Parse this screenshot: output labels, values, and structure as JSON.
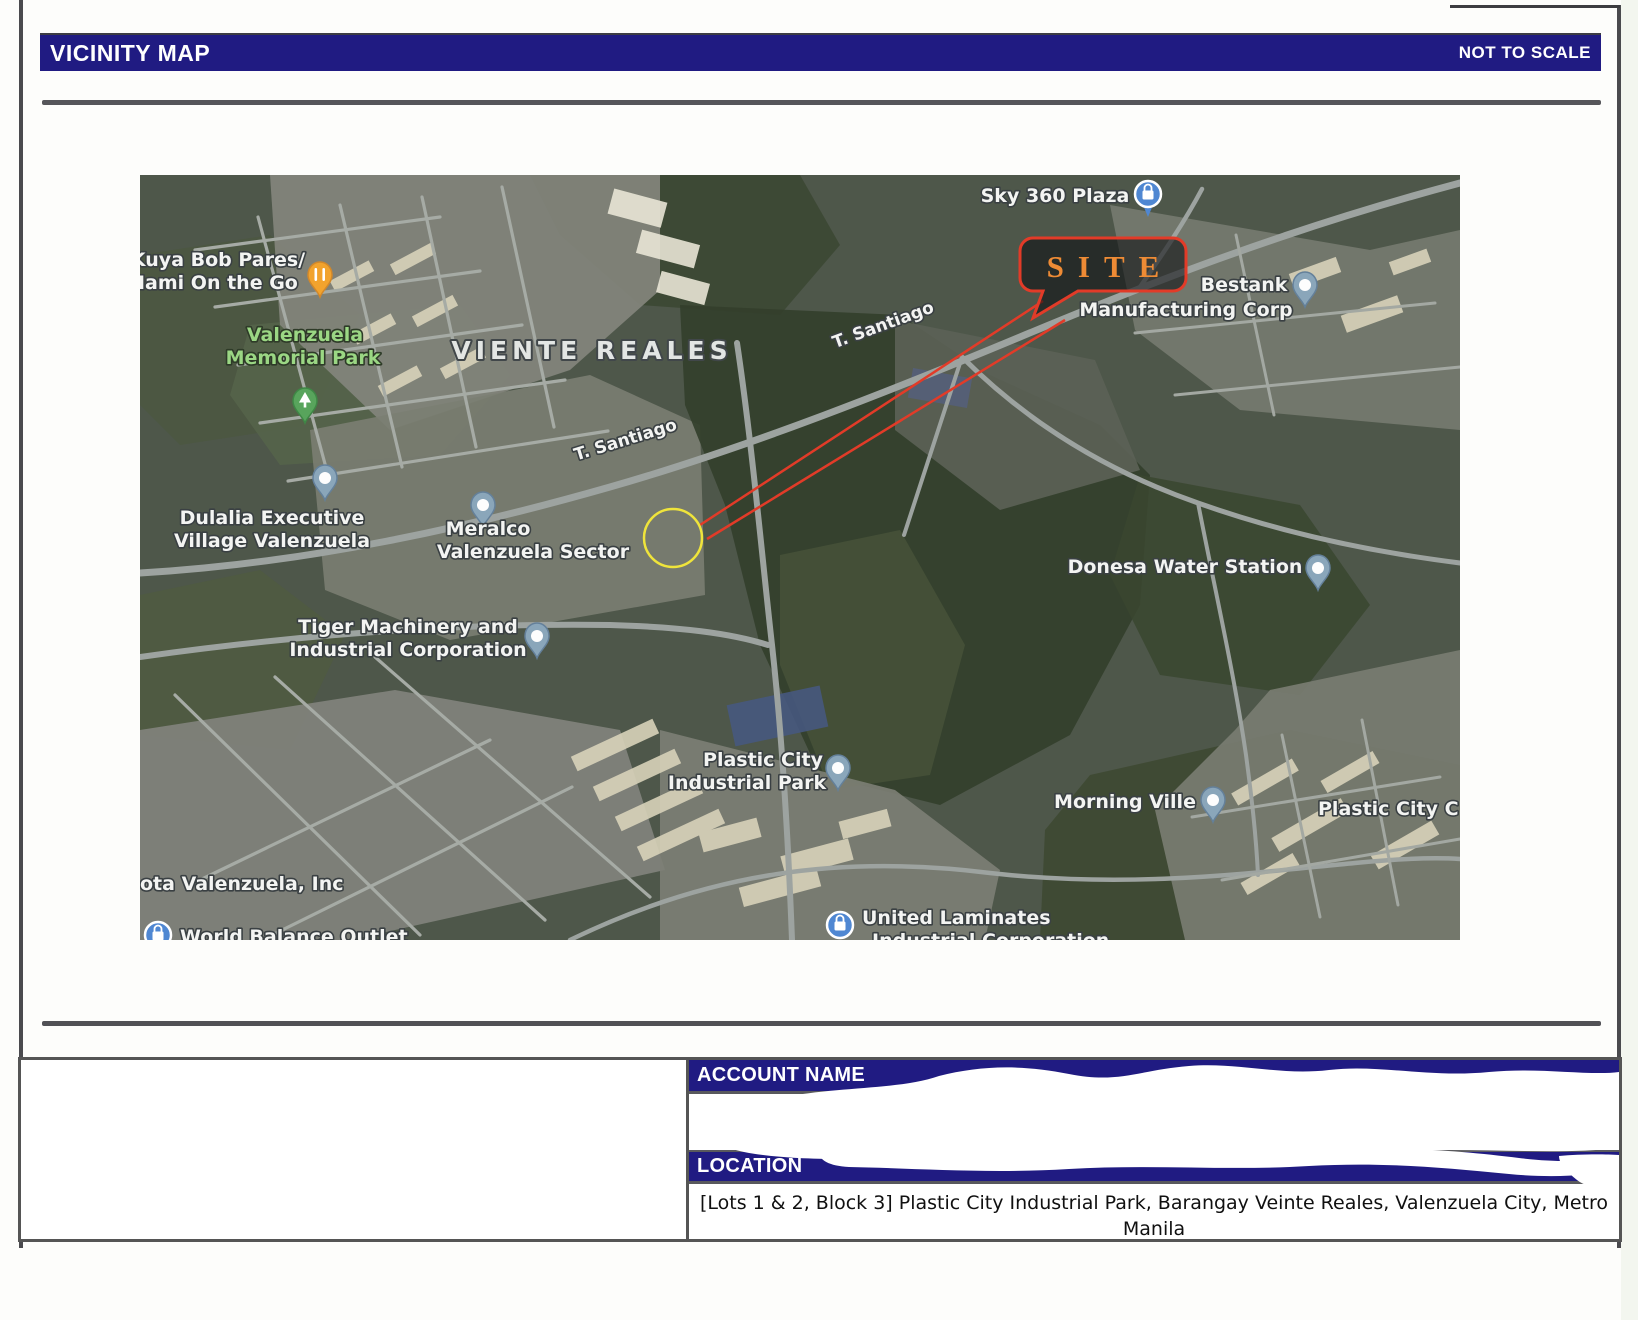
{
  "header": {
    "title": "VICINITY MAP",
    "scale_note": "NOT TO SCALE"
  },
  "map": {
    "area_label": "VIENTE REALES",
    "road_label_1": "T. Santiago",
    "road_label_2": "T. Santiago",
    "site_label": "SITE",
    "places": {
      "sky360": "Sky 360 Plaza",
      "bestank_1": "Bestank",
      "bestank_2": "Manufacturing Corp",
      "kuya_1": "Kuya Bob Pares/",
      "kuya_2": "Mami On the Go",
      "memorial_1": "Valenzuela",
      "memorial_2": "Memorial Park",
      "dulalia_1": "Dulalia Executive",
      "dulalia_2": "Village Valenzuela",
      "meralco_1": "Meralco",
      "meralco_2": "Valenzuela Sector",
      "tiger_1": "Tiger Machinery and",
      "tiger_2": "Industrial Corporation",
      "donesa": "Donesa Water Station",
      "plastic_1": "Plastic City",
      "plastic_2": "Industrial Park",
      "morning": "Morning Ville",
      "plastic_c": "Plastic City C",
      "toyota": "ota Valenzuela, Inc",
      "world": "World Balance Outlet",
      "united_1": "United Laminates",
      "united_2": "Industrial Corporation"
    },
    "colors": {
      "header_navy": "#201b82",
      "site_stroke": "#e23b28",
      "site_text": "#ee8b35",
      "target_circle_yellow": "#efe43b",
      "pin_blue_gray": "#8aa6ba",
      "poi_blue": "#4f87d2",
      "pin_orange": "#f2a32d",
      "pin_green": "#58a45c",
      "label_green": "#9bd784"
    }
  },
  "account": {
    "label": "ACCOUNT NAME"
  },
  "location": {
    "label": "LOCATION",
    "value": "[Lots 1 & 2, Block 3] Plastic City Industrial Park, Barangay Veinte Reales, Valenzuela City, Metro Manila"
  }
}
